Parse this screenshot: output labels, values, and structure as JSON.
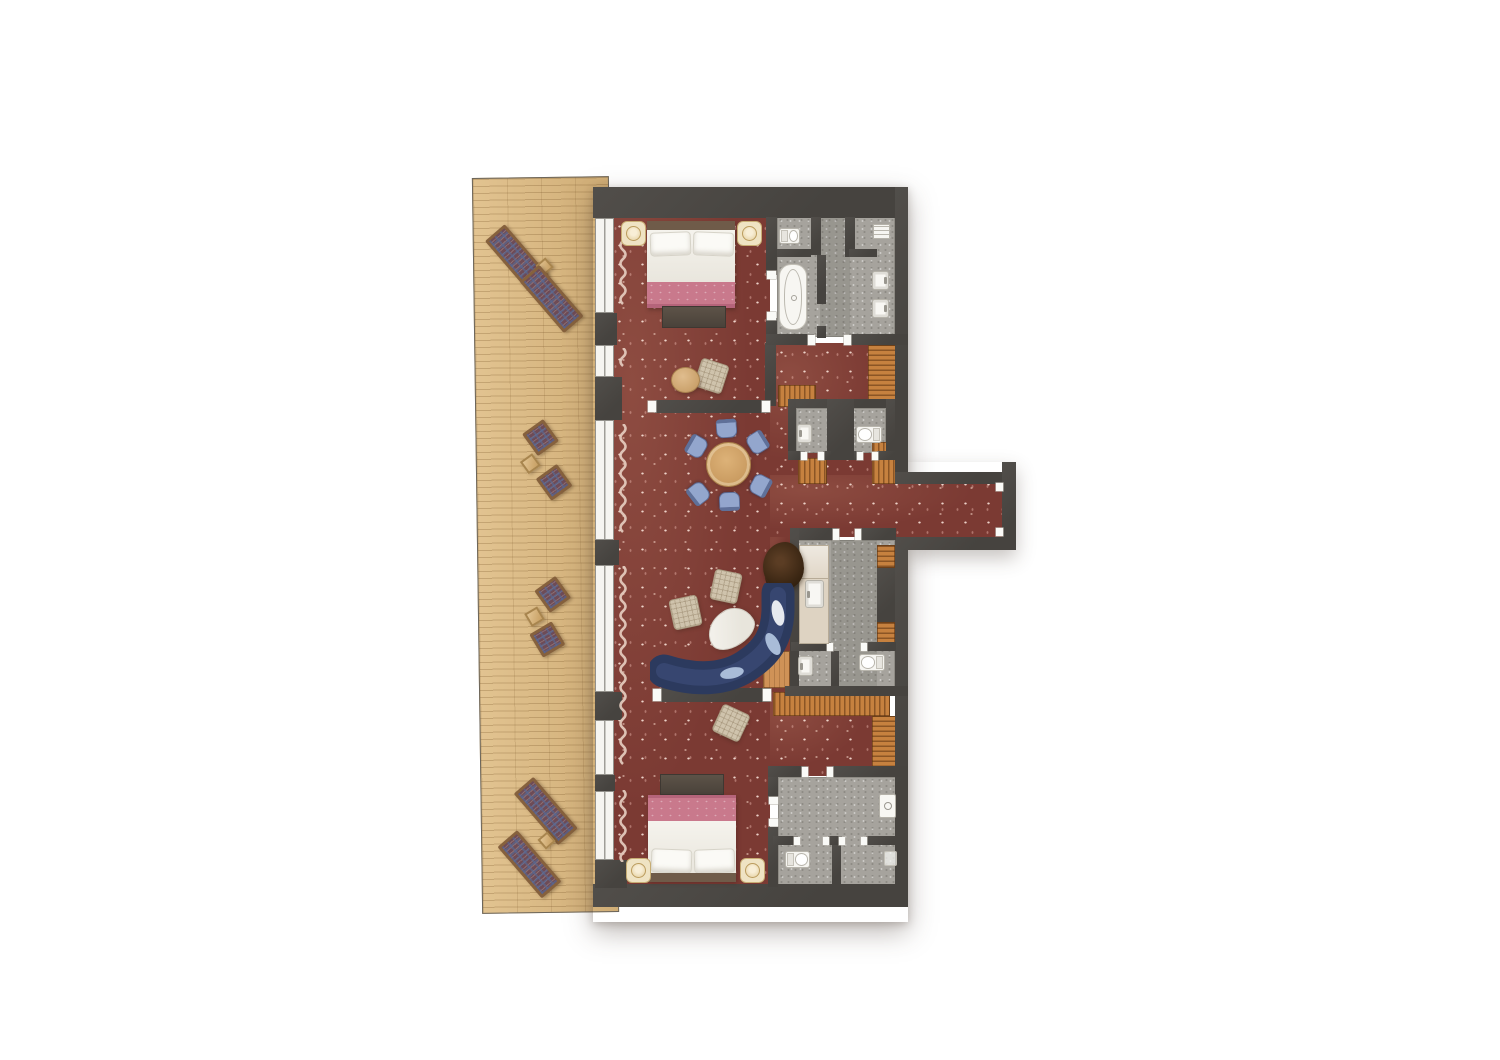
{
  "meta": {
    "type": "architectural-floor-plan",
    "description": "Top-down rendered floor plan of a two-bedroom hotel suite with wooden terrace, red speckled carpet, three bathrooms, dining area and curved blue sofa",
    "visible_text": []
  },
  "colors": {
    "carpet": "#7b3a33",
    "wall": "#4c4945",
    "deck": "#d8b67e",
    "bath": "#a6a39d",
    "wood": "#c6813f",
    "bedpink": "#c9798c",
    "chair": "#93a6cd",
    "sofa": "#2c3a5e",
    "curtain": "#e8cfc2"
  },
  "areas": [
    {
      "name": "terrace",
      "floor": "wood-deck",
      "furniture": [
        "sun-lounger",
        "sun-lounger",
        "side-table",
        "armchair",
        "armchair",
        "side-table",
        "armchair",
        "armchair",
        "side-table",
        "sun-lounger",
        "sun-lounger",
        "side-table"
      ]
    },
    {
      "name": "bedroom-top",
      "floor": "red-carpet",
      "furniture": [
        "double-bed",
        "nightstand-lamp",
        "nightstand-lamp",
        "foot-bench",
        "pouf",
        "round-pouf"
      ]
    },
    {
      "name": "bathroom-top",
      "floor": "gray-stone",
      "fixtures": [
        "toilet",
        "bathtub",
        "sink",
        "sink",
        "towel-rack"
      ]
    },
    {
      "name": "hall-closets",
      "floor": "red-carpet",
      "furniture": [
        "wardrobe",
        "wardrobe-bench",
        "closet",
        "closet"
      ]
    },
    {
      "name": "wc-left",
      "fixtures": [
        "hand-sink"
      ]
    },
    {
      "name": "wc-right",
      "fixtures": [
        "toilet"
      ]
    },
    {
      "name": "living-dining",
      "floor": "red-carpet",
      "furniture": [
        "round-dining-table",
        "dining-chair x6",
        "pouf",
        "pouf",
        "egg-coffee-table",
        "curved-blue-sofa",
        "plant"
      ]
    },
    {
      "name": "corridor-entry",
      "floor": "red-carpet"
    },
    {
      "name": "bathroom-middle",
      "floor": "gray-stone",
      "fixtures": [
        "vanity-sink",
        "hand-sink",
        "toilet",
        "shelves"
      ]
    },
    {
      "name": "bedroom-bottom",
      "floor": "red-carpet",
      "furniture": [
        "double-bed",
        "nightstand-lamp",
        "nightstand-lamp",
        "foot-bench",
        "pouf",
        "l-shaped-wardrobe"
      ]
    },
    {
      "name": "bathroom-bottom",
      "floor": "gray-stone",
      "fixtures": [
        "shower-control",
        "toilet",
        "floor-drain"
      ]
    }
  ]
}
